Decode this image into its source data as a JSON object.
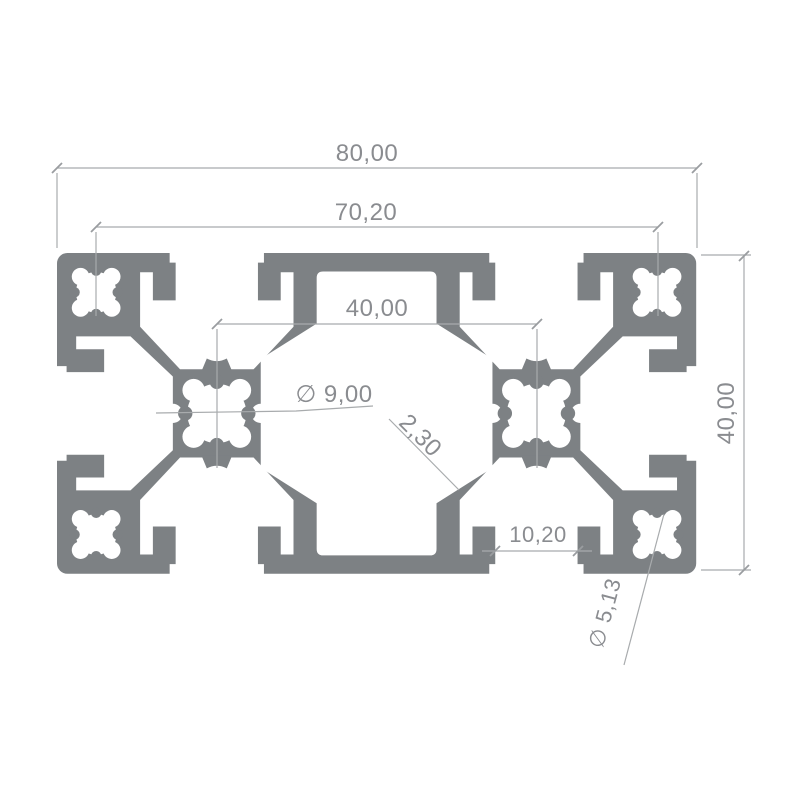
{
  "drawing": {
    "kind": "technical-drawing-cross-section",
    "colors": {
      "profile_fill": "#7d8184",
      "dimension_lines": "#a8abad",
      "dimension_text": "#8a8c90",
      "background": "#ffffff"
    },
    "dimensions": {
      "overall_width": "80,00",
      "corner_hole_spacing": "70,20",
      "center_hole_spacing": "40,00",
      "core_hole_diameter": "∅ 9,00",
      "wall_thickness": "2,30",
      "overall_height": "40,00",
      "slot_opening_width": "10,20",
      "corner_core_hole_diameter": "∅ 5,13"
    }
  }
}
